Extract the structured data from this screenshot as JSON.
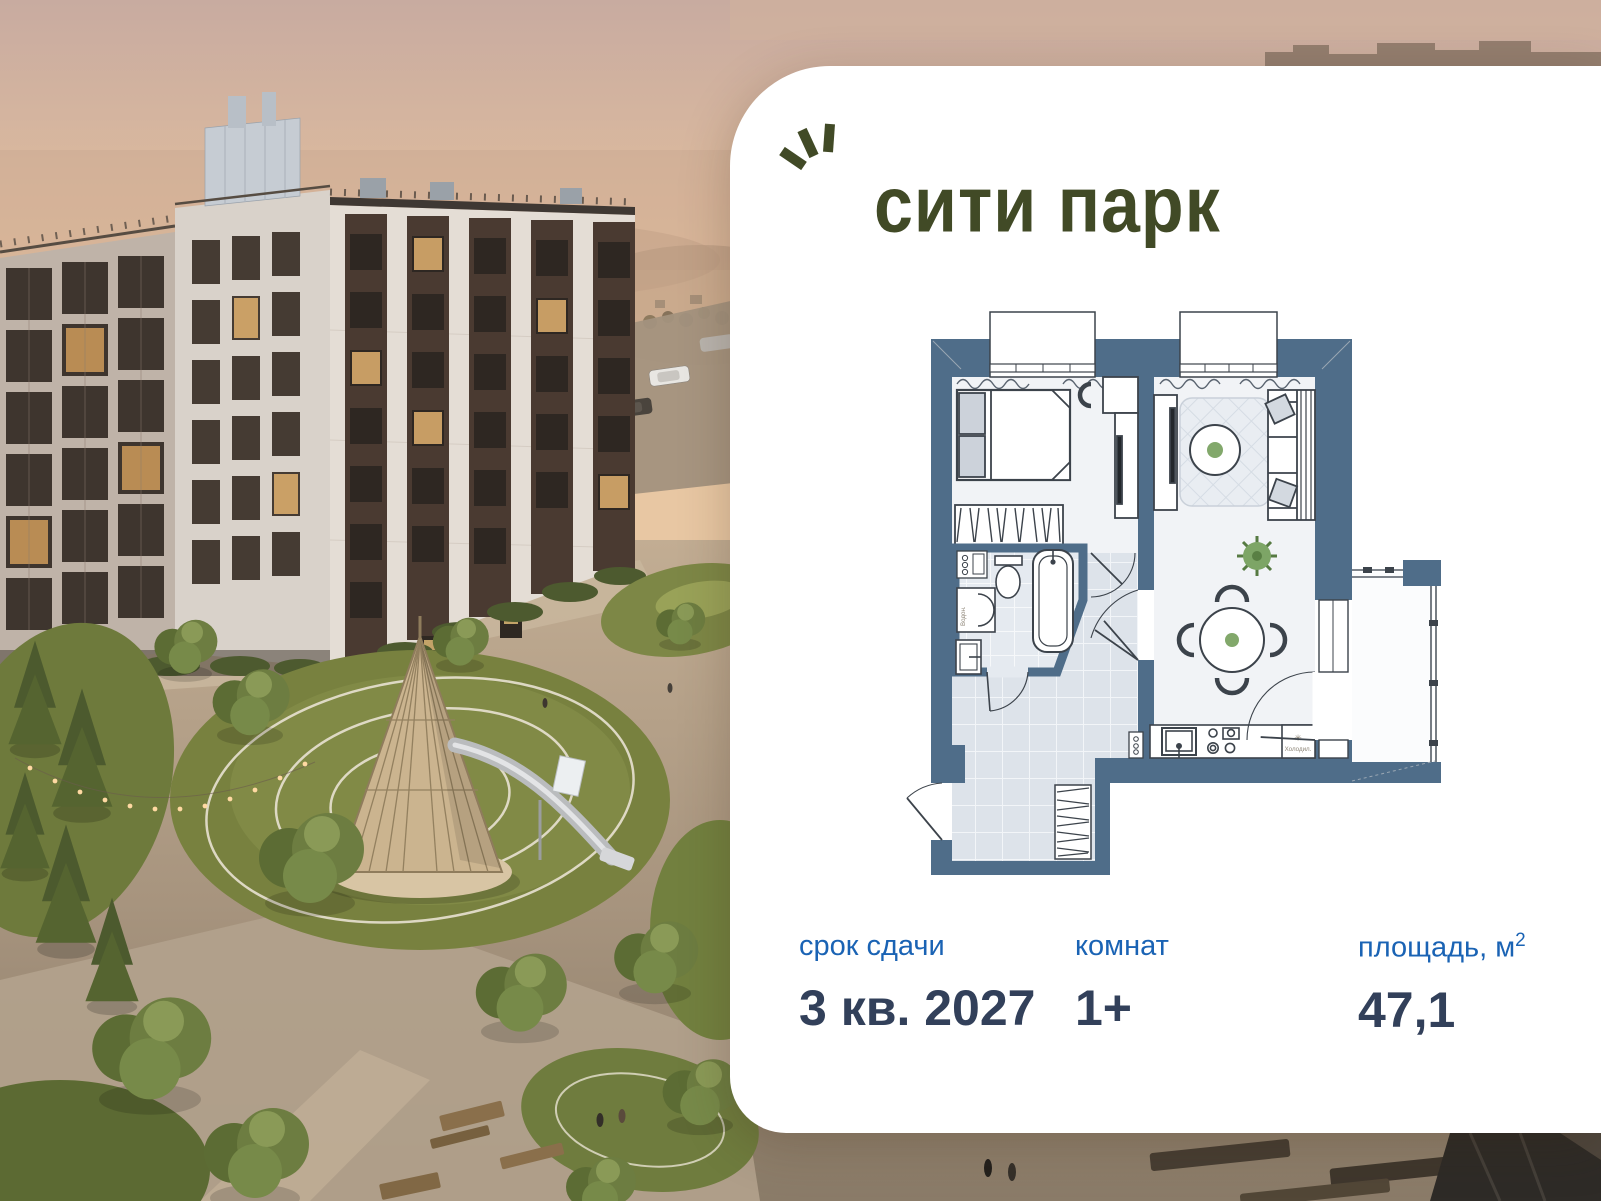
{
  "brand": {
    "logo_text": "сити парк"
  },
  "floorplan": {
    "fridge_symbol": "✳",
    "fridge_label": "Холодил.",
    "heater_label": "Водон."
  },
  "info": {
    "columns": [
      {
        "label": "срок сдачи",
        "value": "3 кв. 2027"
      },
      {
        "label": "комнат",
        "value": "1+"
      },
      {
        "label": "площадь, м",
        "label_sup": "2",
        "value": "47,1"
      }
    ]
  },
  "colors": {
    "logo_green": "#414a26",
    "label_blue": "#1a63b4",
    "value_navy": "#32405a",
    "plan_wall": "#4f6d89",
    "sky_peach": "#e3bfa0",
    "lawn_green": "#78813f"
  }
}
